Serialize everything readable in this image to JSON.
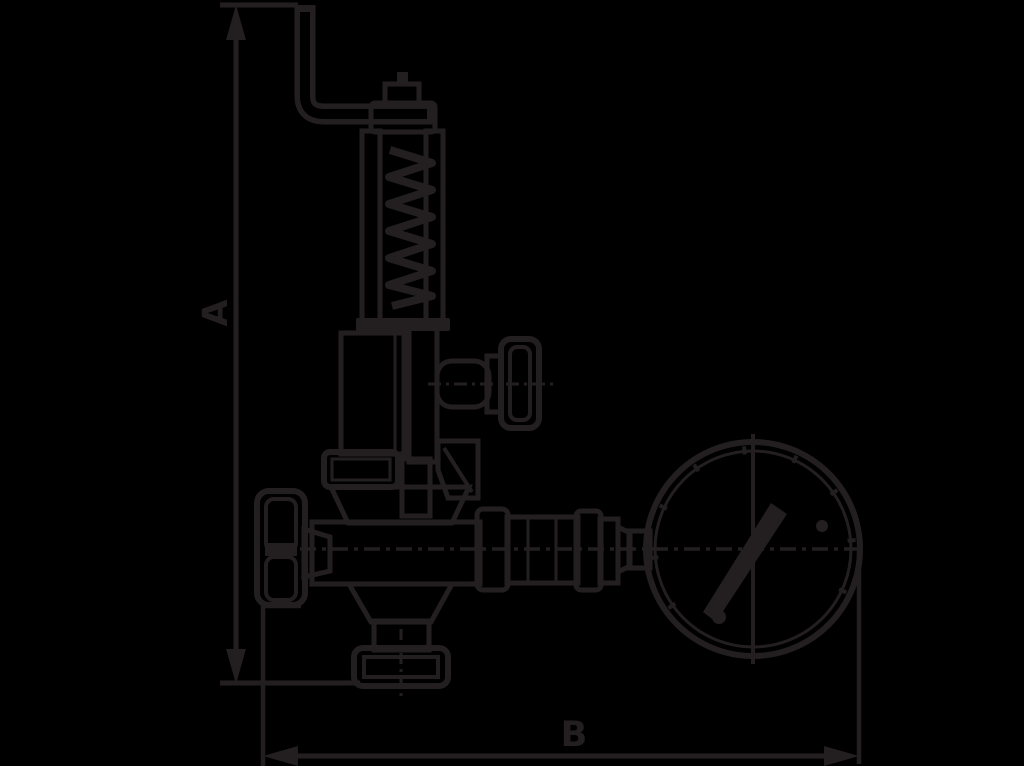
{
  "colors": {
    "background": "#000000",
    "ink": "#231f20"
  },
  "dimensions": {
    "a": {
      "label": "A",
      "orientation": "vertical"
    },
    "b": {
      "label": "B",
      "orientation": "horizontal"
    }
  },
  "figure": {
    "type": "technical-line-drawing",
    "parts": [
      "easing-lever",
      "adjusting-nut",
      "spring-bonnet-cap",
      "spring-bonnet-posts",
      "coil-spring",
      "bonnet-flange",
      "side-handwheel",
      "upper-flange",
      "valve-body",
      "main-handwheel",
      "outlet-funnel",
      "base-flange",
      "gauge-piping-unions",
      "pressure-gauge",
      "gauge-needle",
      "gauge-dial-screws"
    ]
  }
}
